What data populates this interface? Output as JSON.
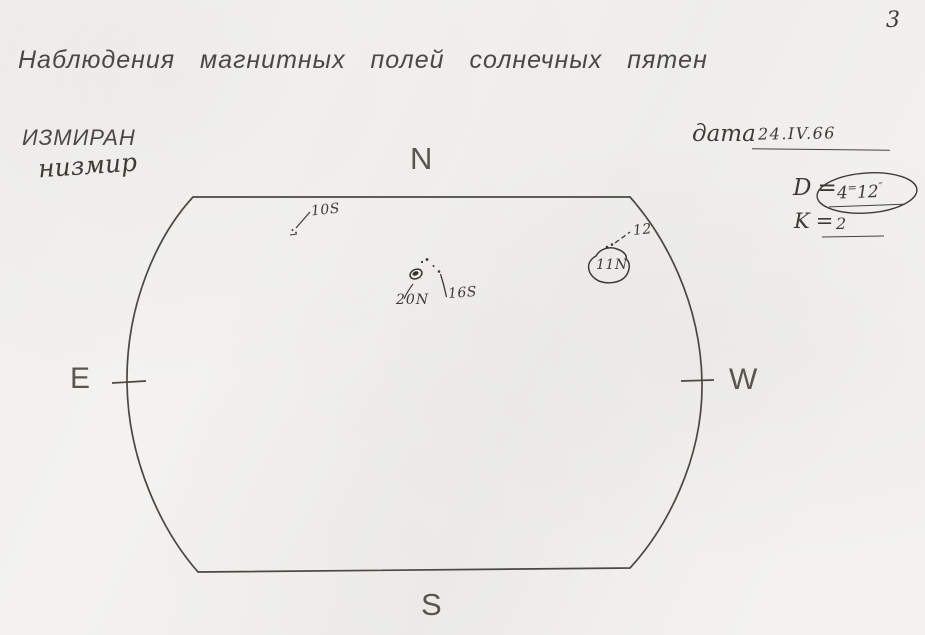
{
  "page": {
    "number": "3",
    "title": "Наблюдения магнитных полей солнечных пятен",
    "organization_printed": "ИЗМИРАН",
    "organization_handwritten": "низмир"
  },
  "fields": {
    "date_label": "дата",
    "date_value": "24.IV.66",
    "diameter_label": "D",
    "equals": "=",
    "diameter_value_first": "4",
    "diameter_value_sup": "=",
    "diameter_value_second": "12",
    "diameter_value_unit": "″",
    "k_label": "K",
    "k_value": "2"
  },
  "compass": {
    "north": "N",
    "south": "S",
    "east": "E",
    "west": "W"
  },
  "annotations": [
    {
      "id": "sunspot-10s",
      "label": "10S"
    },
    {
      "id": "sunspot-20n",
      "label": "20N"
    },
    {
      "id": "sunspot-16s",
      "label": "16S"
    },
    {
      "id": "sunspot-11n",
      "label": "11N"
    },
    {
      "id": "sunspot-12",
      "label": "12"
    }
  ],
  "colors": {
    "paper": "#f3f2ee",
    "ink": "#45423d",
    "pencil": "#3e3b37"
  }
}
